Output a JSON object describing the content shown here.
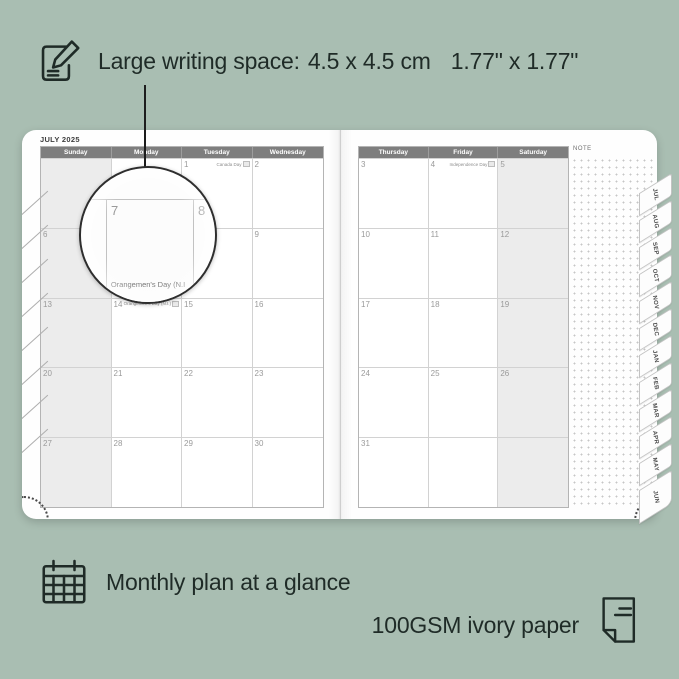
{
  "colors": {
    "background": "#a9beb2",
    "ink": "#1f2b27",
    "header_gray": "#7e7e7e",
    "cell_gray": "#ececec",
    "page_white": "#fefefe"
  },
  "top_callout": {
    "label": "Large writing space:",
    "metric": "4.5 x 4.5 cm",
    "imperial": "1.77\" x 1.77\""
  },
  "planner": {
    "month_title": "JULY 2025",
    "left_page": {
      "day_headers": [
        "Sunday",
        "Monday",
        "Tuesday",
        "Wednesday"
      ],
      "rows": [
        [
          {
            "date": "",
            "gray": true
          },
          {
            "date": ""
          },
          {
            "date": "1",
            "holiday": "Canada Day",
            "flag": "🇨🇦"
          },
          {
            "date": "2"
          }
        ],
        [
          {
            "date": "6",
            "gray": true
          },
          {
            "date": "7"
          },
          {
            "date": "8"
          },
          {
            "date": "9"
          }
        ],
        [
          {
            "date": "13",
            "gray": true
          },
          {
            "date": "14",
            "holiday": "Orangemen's Day (N.I.)",
            "flag": "🇬🇧"
          },
          {
            "date": "15"
          },
          {
            "date": "16"
          }
        ],
        [
          {
            "date": "20",
            "gray": true
          },
          {
            "date": "21"
          },
          {
            "date": "22"
          },
          {
            "date": "23"
          }
        ],
        [
          {
            "date": "27",
            "gray": true
          },
          {
            "date": "28"
          },
          {
            "date": "29"
          },
          {
            "date": "30"
          }
        ]
      ]
    },
    "right_page": {
      "day_headers": [
        "Thursday",
        "Friday",
        "Saturday"
      ],
      "note_label": "NOTE",
      "rows": [
        [
          {
            "date": "3"
          },
          {
            "date": "4",
            "holiday": "Independence Day",
            "flag": "🇺🇸"
          },
          {
            "date": "5",
            "gray": true
          }
        ],
        [
          {
            "date": "10"
          },
          {
            "date": "11"
          },
          {
            "date": "12",
            "gray": true
          }
        ],
        [
          {
            "date": "17"
          },
          {
            "date": "18"
          },
          {
            "date": "19",
            "gray": true
          }
        ],
        [
          {
            "date": "24"
          },
          {
            "date": "25"
          },
          {
            "date": "26",
            "gray": true
          }
        ],
        [
          {
            "date": "31"
          },
          {
            "date": ""
          },
          {
            "date": "",
            "gray": true
          }
        ]
      ]
    },
    "month_tabs": [
      "JUL",
      "AUG",
      "SEP",
      "OCT",
      "NOV",
      "DEC",
      "JAN",
      "FEB",
      "MAR",
      "APR",
      "MAY",
      "JUN"
    ],
    "magnifier": {
      "day": "7",
      "next_day": "8",
      "holiday_preview": "Orangemen's Day (N.I"
    }
  },
  "bottom_callouts": {
    "monthly": "Monthly plan at a glance",
    "paper": "100GSM ivory paper"
  }
}
